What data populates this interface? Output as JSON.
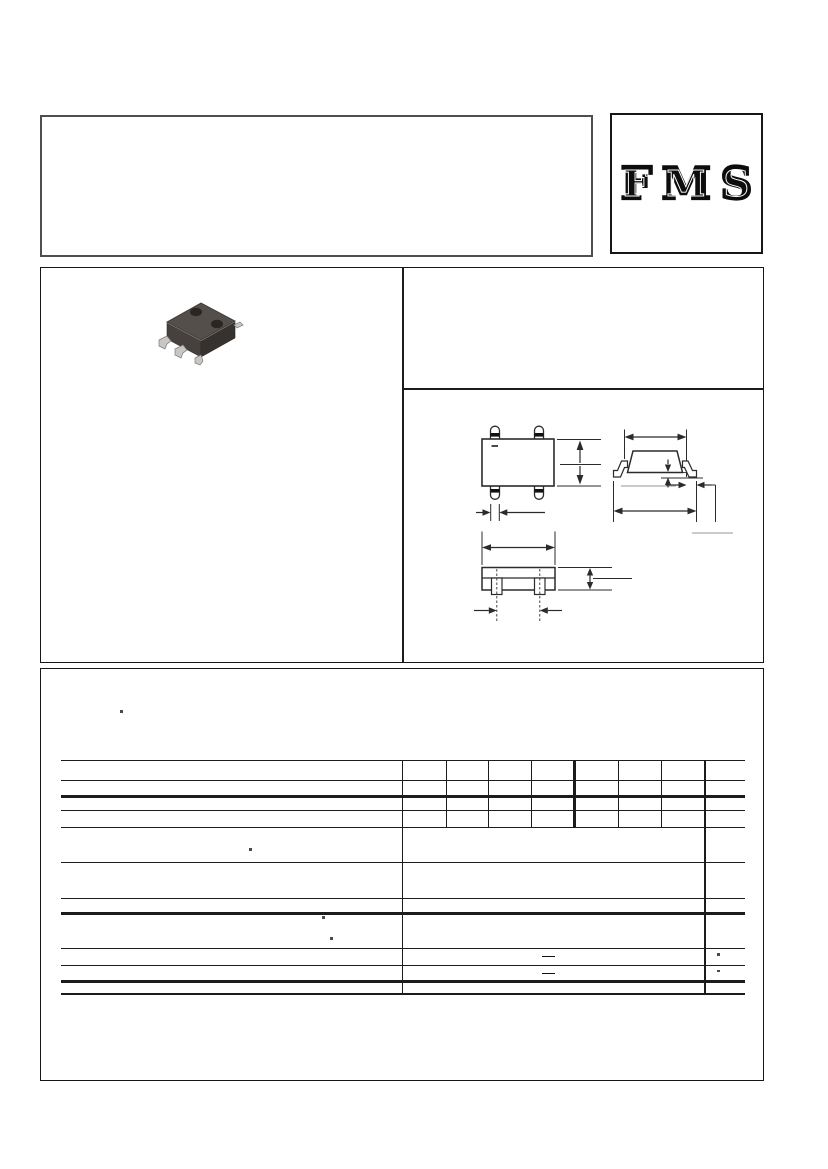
{
  "brand": {
    "logo_text": "FMS"
  },
  "palette": {
    "page_bg": "#ffffff",
    "title_box_border": "#4f4f4f",
    "panel_border": "#161616",
    "table_rule": "#1c1c1c",
    "drawing_line": "#2b2b2b",
    "drawing_gray_line": "#b8b8b8",
    "chip_top": "#544f4b",
    "chip_front": "#46413e",
    "chip_side": "#36322f",
    "chip_hole": "#292624",
    "chip_lead": "#c9c7c5"
  },
  "title_panel": {
    "content": ""
  },
  "features_panel": {
    "content": ""
  },
  "package_views": {
    "names": [
      "top-view",
      "side-view",
      "front-view"
    ],
    "top_view_polarity_mark": "minus"
  },
  "ratings_table": {
    "narrow_column_count": 7,
    "note_bullets": [
      "•",
      "•",
      "•",
      "•"
    ],
    "value_dashes": [
      "—",
      "—"
    ],
    "unit_dots": [
      "·",
      "·"
    ]
  }
}
